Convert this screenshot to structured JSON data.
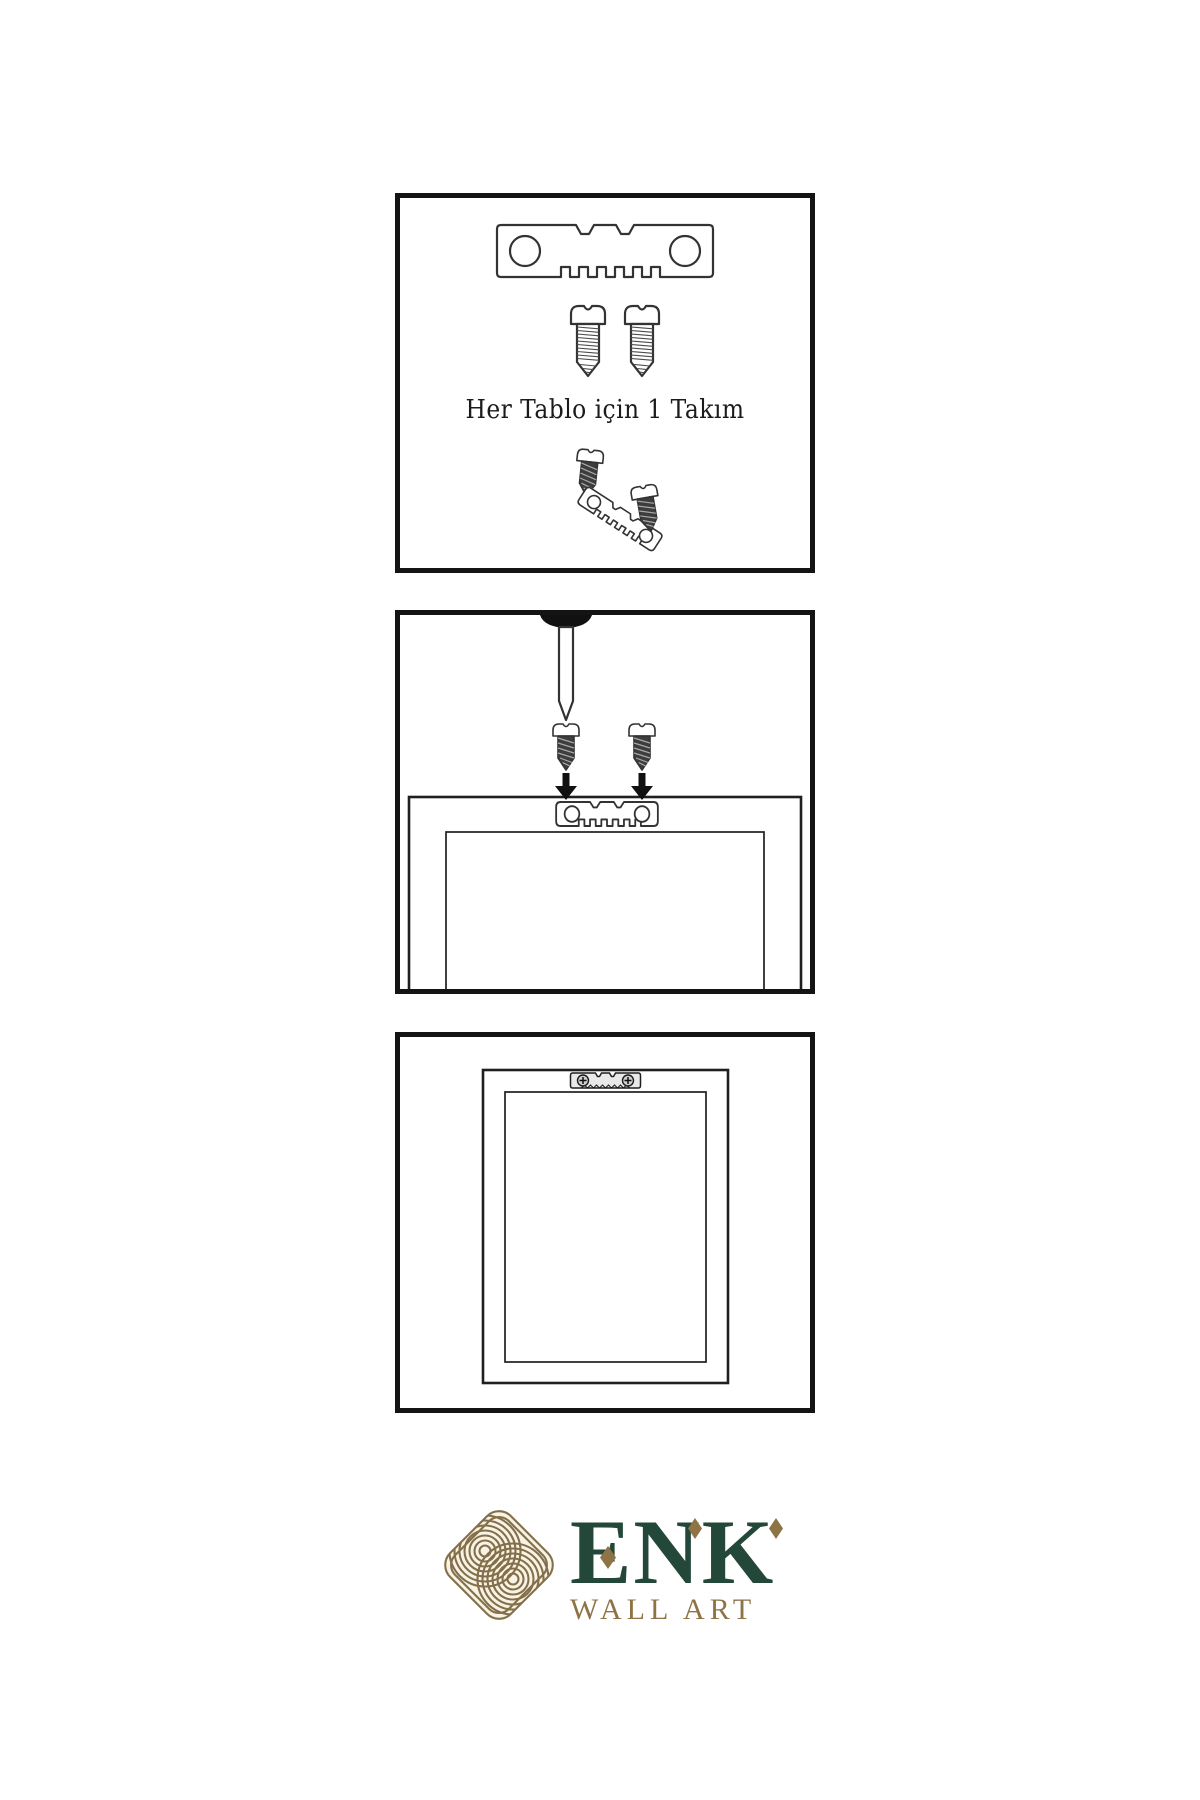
{
  "steps": {
    "step1": {
      "caption": "Her Tablo için 1 Takım",
      "icons": [
        "sawtooth-hanger-icon",
        "screw-icon",
        "screw-icon",
        "screw-icon",
        "tilted-sawtooth-hanger-icon",
        "screw-icon"
      ]
    },
    "step2": {
      "caption": "",
      "icons": [
        "wall-nail-icon",
        "screw-icon",
        "screw-icon",
        "down-arrow-icon",
        "down-arrow-icon",
        "frame-back-icon",
        "sawtooth-hanger-icon"
      ]
    },
    "step3": {
      "caption": "",
      "icons": [
        "frame-back-icon",
        "mounted-sawtooth-hanger-icon"
      ]
    }
  },
  "brand": {
    "name": "ENK",
    "tagline": "WALL ART",
    "logo_icon": "celtic-knot-icon"
  },
  "colors": {
    "brand_green": "#234839",
    "brand_gold": "#8d7346",
    "knot_gold": "#83704a",
    "line": "#333333",
    "panel_border": "#141414",
    "dark_metal": "#3d3d3d"
  }
}
